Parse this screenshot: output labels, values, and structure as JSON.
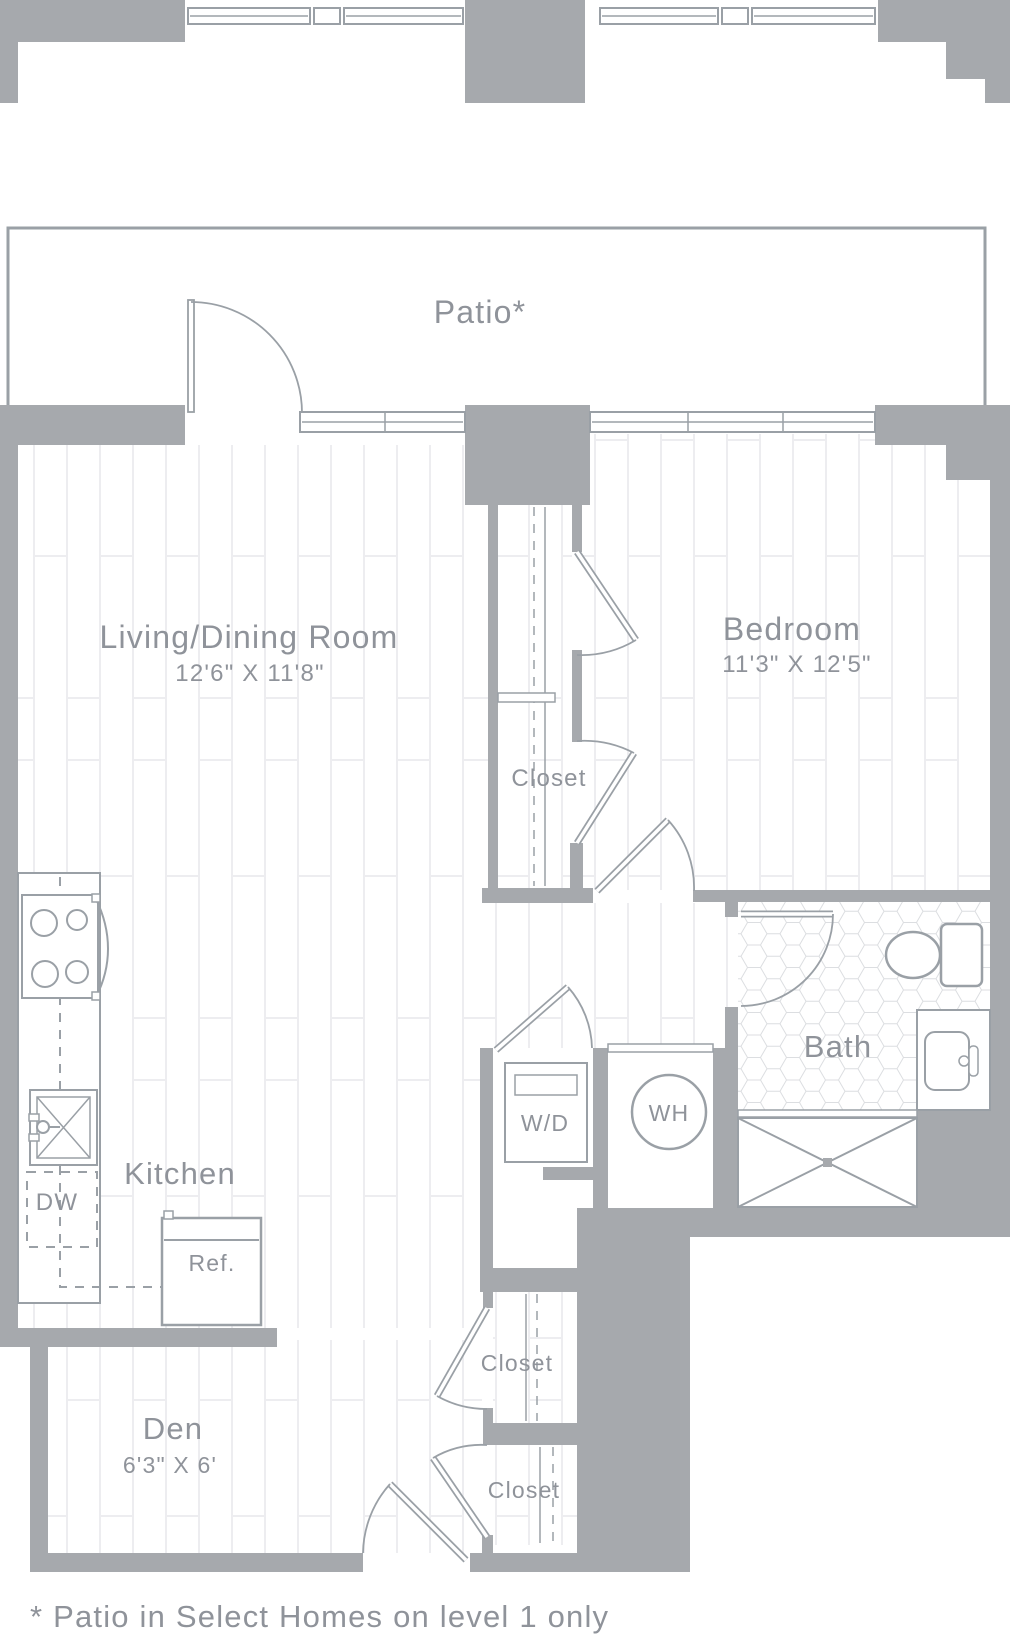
{
  "plan": {
    "title": "One-bedroom apartment floor plan",
    "footnote": "* Patio in Select Homes on level 1 only",
    "rooms": {
      "patio": {
        "label": "Patio*"
      },
      "living": {
        "label": "Living/Dining Room",
        "dims": "12'6\" X 11'8\""
      },
      "bedroom": {
        "label": "Bedroom",
        "dims": "11'3\" X 12'5\""
      },
      "closet_main": {
        "label": "Closet"
      },
      "bath": {
        "label": "Bath"
      },
      "kitchen": {
        "label": "Kitchen"
      },
      "den": {
        "label": "Den",
        "dims": "6'3\" X 6'"
      },
      "closet_hall_upper": {
        "label": "Closet"
      },
      "closet_hall_lower": {
        "label": "Closet"
      }
    },
    "fixtures": {
      "washer_dryer": "W/D",
      "water_heater": "WH",
      "dishwasher": "DW",
      "refrigerator": "Ref."
    },
    "colors": {
      "wall": "#a6a9ad",
      "line": "#9aa0a6",
      "text": "#8f939a",
      "plank": "#ededf0",
      "tile": "#dcdee1",
      "background": "#ffffff"
    }
  }
}
